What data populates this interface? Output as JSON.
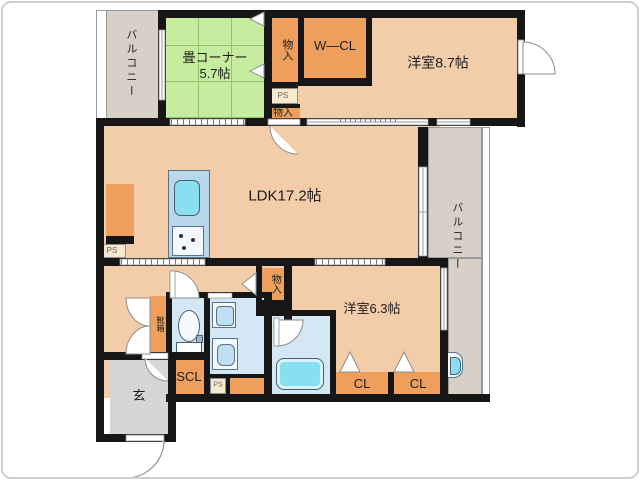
{
  "plan": {
    "type": "japanese-apartment-floor-plan",
    "labels": {
      "balcony_left": "バルコニー",
      "balcony_right": "バルコニー",
      "tatami_name": "畳コーナー",
      "tatami_size": "5.7帖",
      "storage_top": "物入",
      "walk_in_closet": "W—CL",
      "bedroom_large": "洋室8.7帖",
      "ps_top": "PS",
      "storage_mid": "物入",
      "ldk": "LDK17.2帖",
      "ps_left": "PS",
      "storage_lower": "物入",
      "bedroom_small": "洋室6.3帖",
      "shoe_box": "靴箱",
      "shoe_closet": "SCL",
      "ps_bottom": "PS",
      "closet_1": "CL",
      "closet_2": "CL",
      "entrance": "玄"
    },
    "colors": {
      "wall": "#161616",
      "room_peach": "#f3cda9",
      "closet_orange": "#ee9f5c",
      "tatami_green": "#c6ec9f",
      "tatami_grid": "#8fc46a",
      "water_room_blue": "#d4e7f4",
      "fixture_cyan": "#8adef2",
      "kitchen_counter": "#b9d8ec",
      "ps_cream": "#f7e9ce",
      "balcony_beige": "#d8d0c6",
      "entrance_gray": "#d6d6d6"
    }
  }
}
